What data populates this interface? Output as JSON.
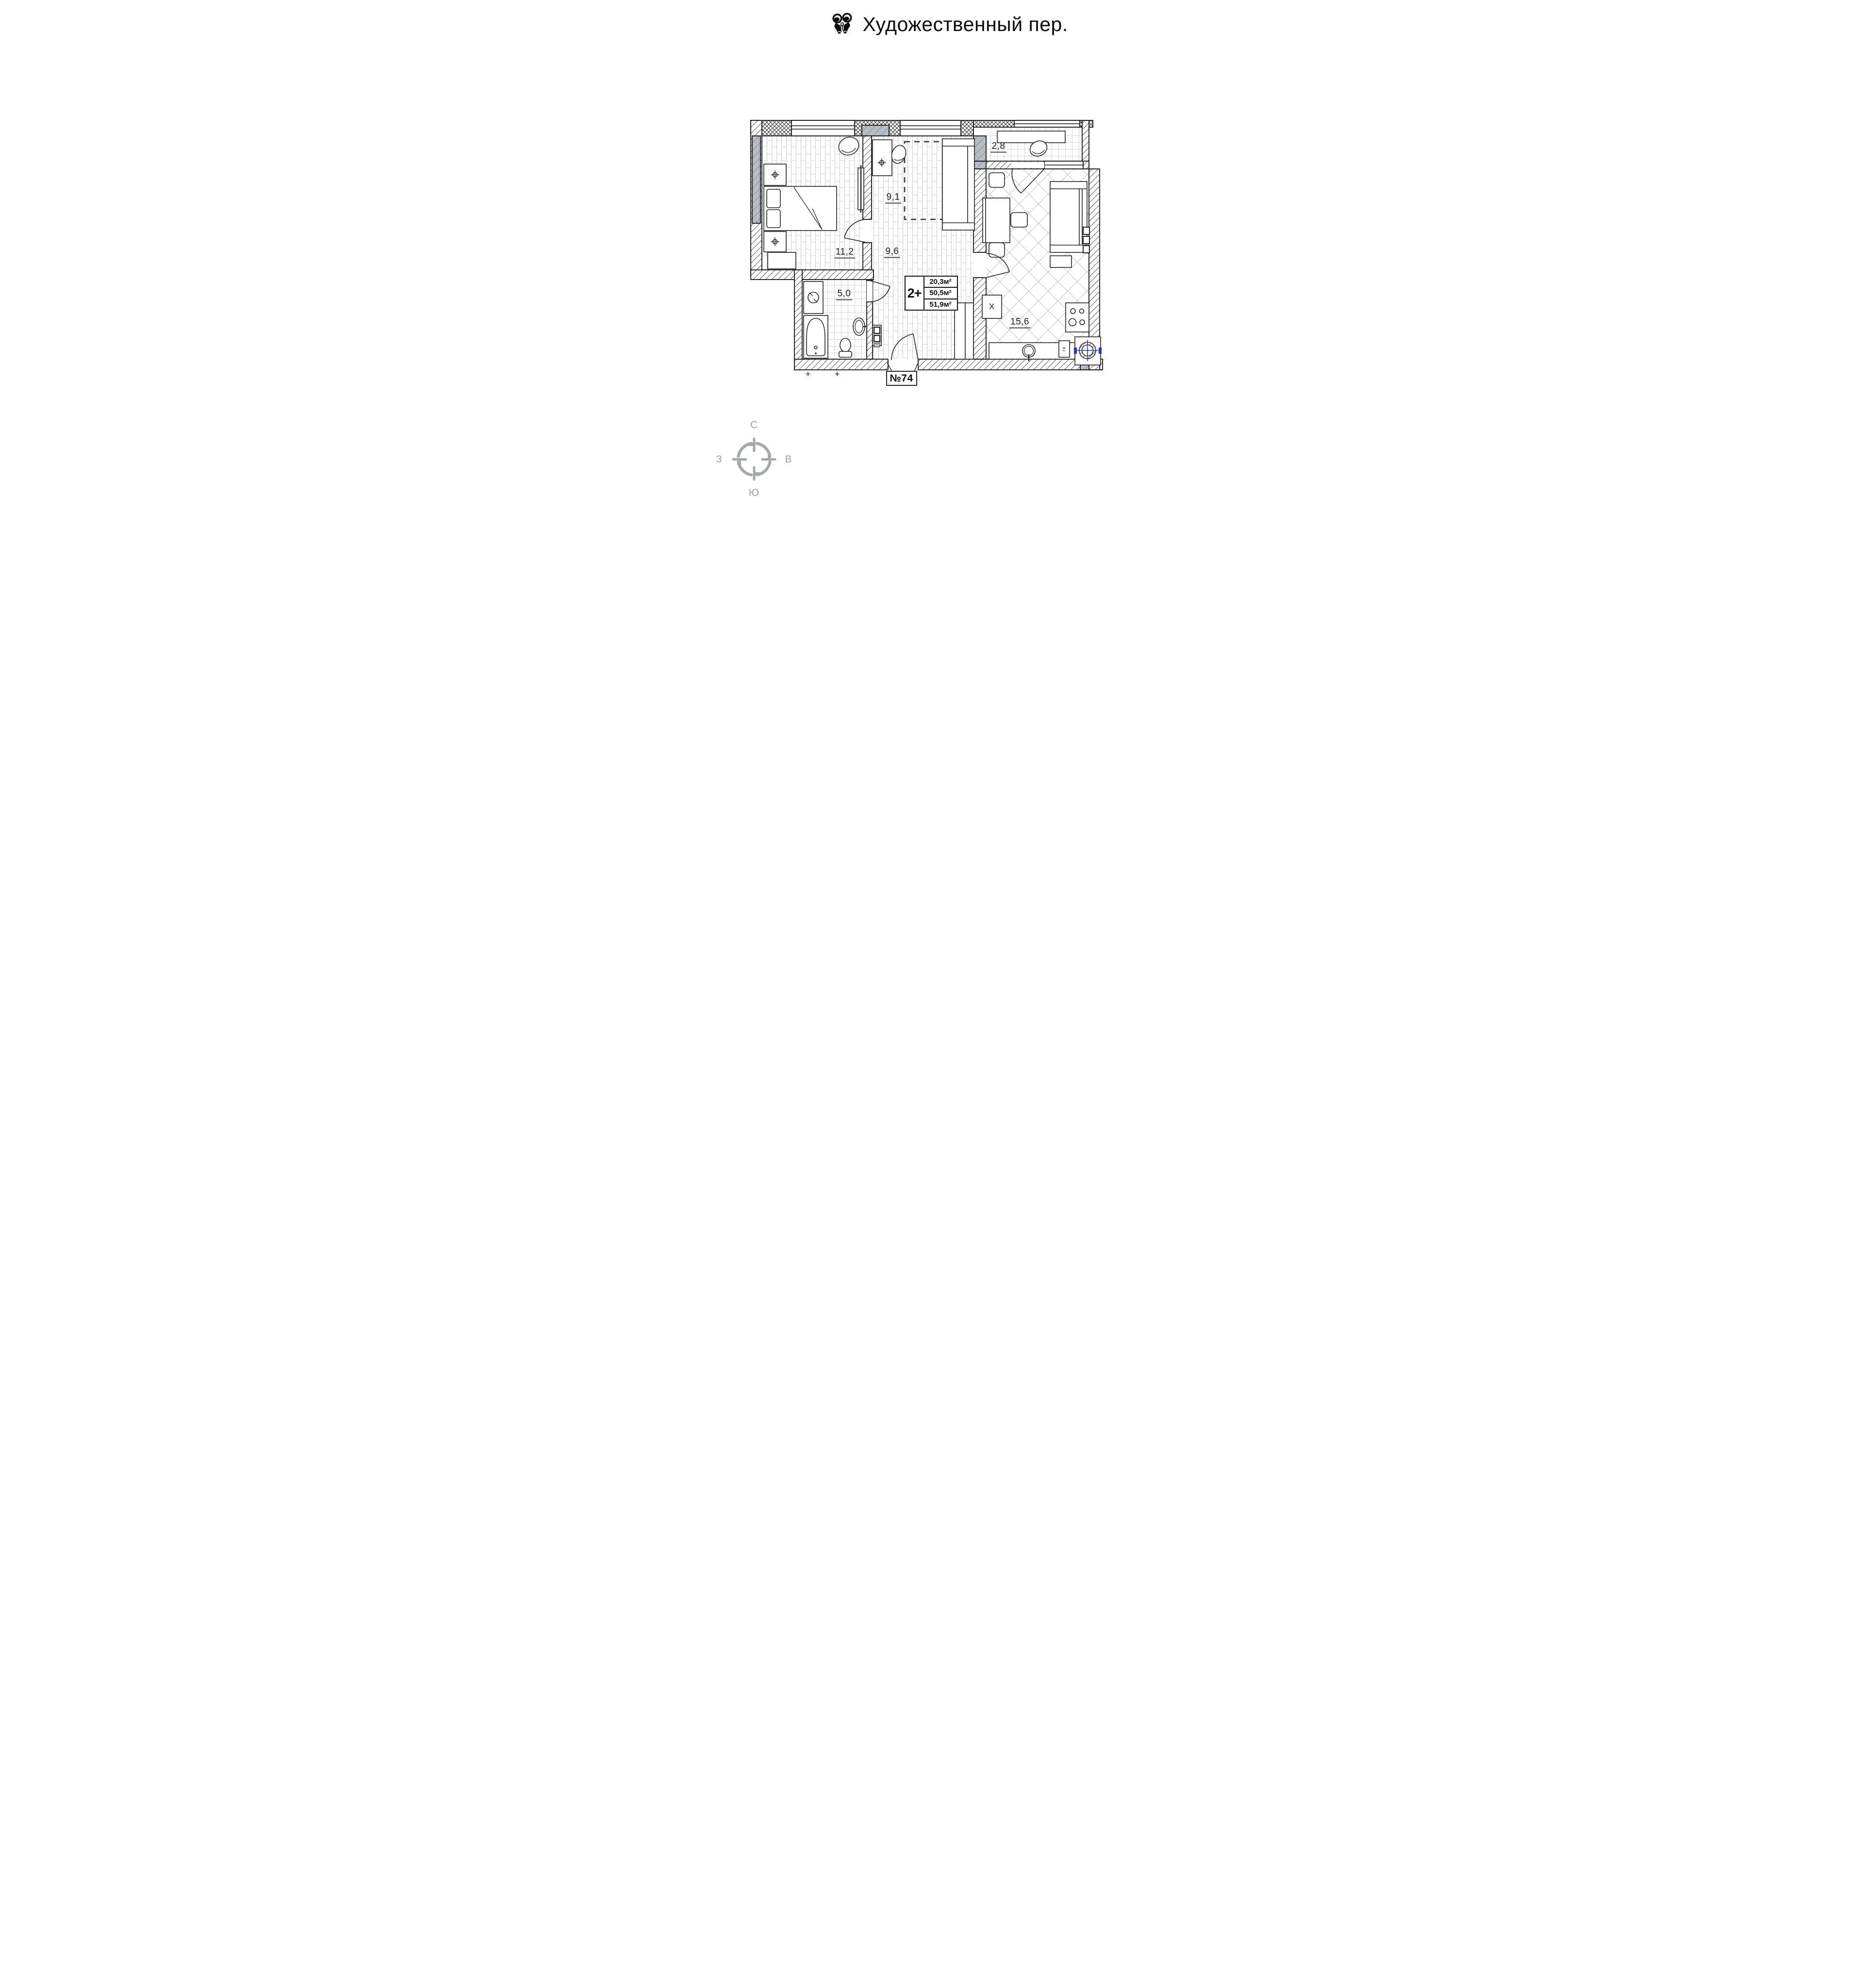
{
  "header": {
    "title": "Художественный пер.",
    "icon": "binoculars-icon"
  },
  "plan": {
    "apartment_number": "№74",
    "info_box": {
      "rooms_type": "2+",
      "living_area": "20,3м²",
      "area_without_balcony": "50,5м²",
      "total_area": "51,9м²"
    },
    "room_labels": {
      "bedroom": "11,2",
      "study": "9,1",
      "hallway": "9,6",
      "bathroom": "5,0",
      "kitchen_living": "15,6",
      "balcony": "2,8"
    },
    "fixture_labels": {
      "fridge": "X",
      "gas_boiler": "гк"
    }
  },
  "compass": {
    "north": "С",
    "east": "В",
    "south": "Ю",
    "west": "З"
  },
  "colors": {
    "line": "#1a1a1a",
    "concrete_gray": "#b7bdc3",
    "floor_line_gray": "#c9c9c9",
    "plumbing_blue": "#2633c4",
    "compass_gray": "#9ba1a6"
  }
}
